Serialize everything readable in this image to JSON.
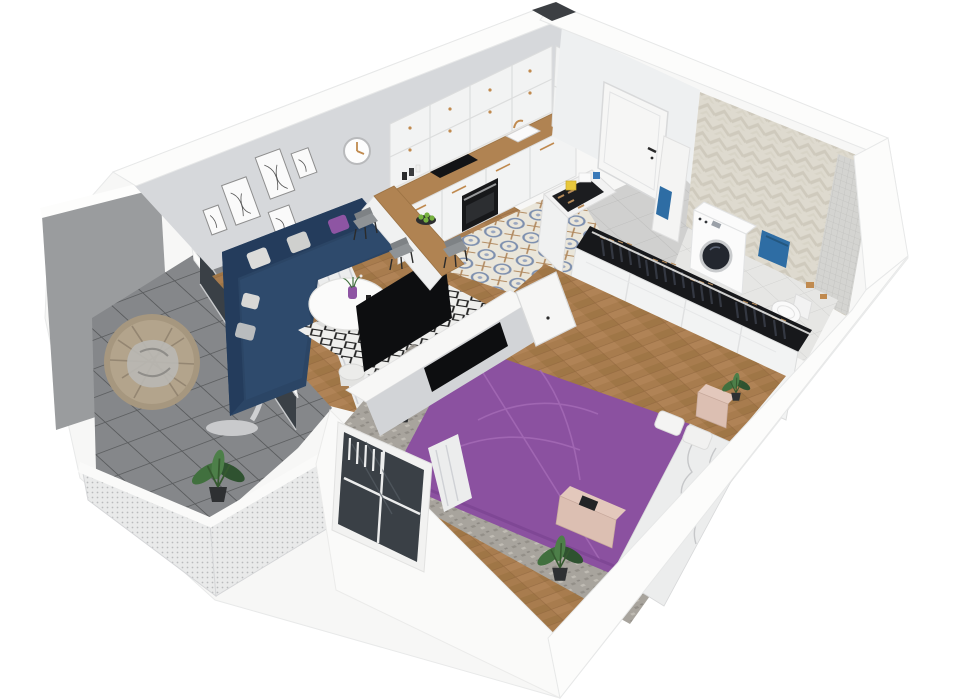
{
  "scene": {
    "type": "3d-apartment-floor-plan-render",
    "view": "isometric-cutaway",
    "background": "#ffffff",
    "rooms": [
      {
        "name": "living-room",
        "items": [
          "corner-sofa",
          "throw-pillows",
          "coffee-table",
          "flower-vase",
          "drum-side-table",
          "diamond-pattern-rug",
          "gallery-wall-frames",
          "wall-clock",
          "curtains",
          "tv",
          "herringbone-wood-floor"
        ]
      },
      {
        "name": "kitchen",
        "items": [
          "upper-cabinets",
          "lower-cabinets",
          "oven",
          "cooktop",
          "sink",
          "gold-faucet",
          "marble-backsplash",
          "wood-countertop",
          "peninsula-bar",
          "fruit-bowl",
          "dining-chairs",
          "tall-cabinet",
          "patterned-tile-floor"
        ]
      },
      {
        "name": "entry-hall",
        "items": [
          "front-door",
          "shoe-cabinet",
          "storage-boxes",
          "gray-tile-floor",
          "ventilation-shaft"
        ]
      },
      {
        "name": "bathroom",
        "items": [
          "herringbone-tile-wall",
          "mosaic-shower-wall",
          "washing-machine",
          "blue-towels",
          "toilet",
          "toilet-paper-holder",
          "tile-floor"
        ]
      },
      {
        "name": "bedroom",
        "items": [
          "double-bed-purple-duvet",
          "white-bedding",
          "pillows",
          "wardrobe-with-hanging-clothes",
          "nightstand",
          "foot-bench",
          "tv-partition-wall",
          "open-door",
          "window",
          "sheer-curtain",
          "potted-plants",
          "mottled-rug",
          "herringbone-wood-floor"
        ]
      },
      {
        "name": "balcony",
        "items": [
          "hanging-egg-chair",
          "potted-plant",
          "mesh-railing",
          "privacy-panel",
          "glass-door",
          "tile-floor"
        ]
      }
    ]
  },
  "palette": {
    "wall_top": "#fcfcfb",
    "wall_white": "#f7f7f6",
    "wall_face": "#d6d8db",
    "wall_ne_face": "#eef0f1",
    "floor_wood": "#a87c4e",
    "wood_dark": "#96703f",
    "wood_light": "#b5895c",
    "kitchen_tile_bg": "#eae6da",
    "kitchen_tile_blue": "#7d8fae",
    "hall_tile": "#d0d0cf",
    "balcony_tile": "#85878a",
    "balcony_grout": "#5a5c5e",
    "bath_wall": "#dedacf",
    "bath_wall_dark": "#cfcabd",
    "mosaic": "#d4d4d1",
    "bath_floor": "#e6e6e4",
    "sofa_navy": "#2b4565",
    "sofa_dark": "#243c5c",
    "sofa_light": "#2e4a6c",
    "accent_purple": "#8e55a3",
    "bed_purple": "#8b51a0",
    "bed_purple_dark": "#7a4390",
    "rug_white": "#efefed",
    "rug_black": "#202020",
    "bedroom_rug": "#a8a49d",
    "counter_wood": "#b08352",
    "gold": "#c08a4f",
    "cabinet_white": "#f2f3f3",
    "tv_black": "#0d0e10",
    "towel_blue": "#2e6da4",
    "washer_white": "#fbfbfb",
    "drum_dark": "#23272f",
    "glass_dark": "#3a4046",
    "curtain": "#eceded",
    "chair_gray": "#8f9396",
    "plant_green": "#41703e",
    "plant_dark": "#2f5230",
    "pink_wood": "#dcbfb2",
    "pink_wood_top": "#e3c8bc",
    "box_yellow": "#e8c83c",
    "clothes_dark": "#17181b",
    "shoe_tan": "#b58a59",
    "apple_green": "#76b13f"
  }
}
